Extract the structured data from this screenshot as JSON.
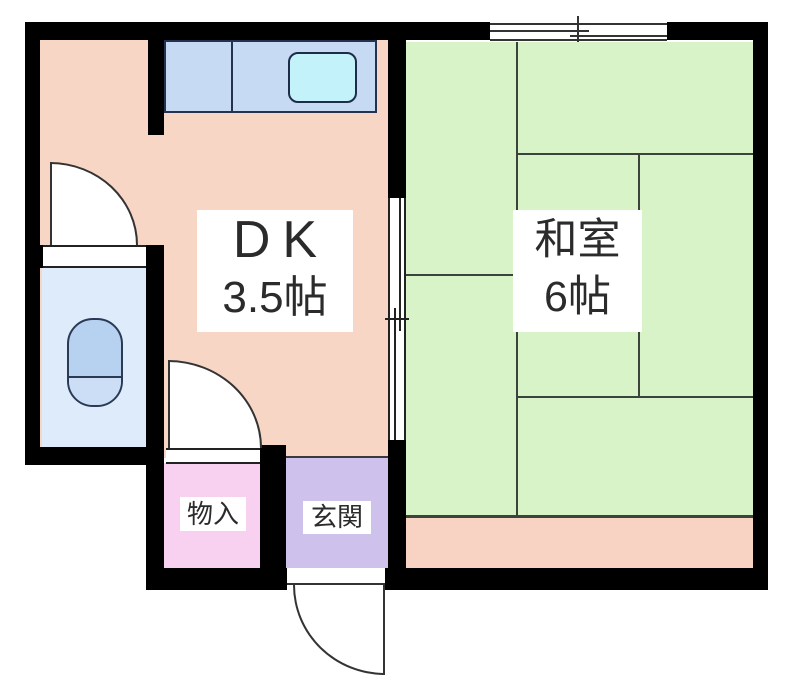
{
  "colors": {
    "background": "#ffffff",
    "wall": "#000000",
    "tatami_line": "#3a443a",
    "outline": "#333333",
    "text": "#2b2b2b",
    "dk_fill": "#f8d6c6",
    "washitsu_fill": "#d9f3c8",
    "veranda_fill": "#f8d2c3",
    "toilet_room_fill": "#ddebfa",
    "toilet_fixture_fill": "#b7d2f0",
    "toilet_bowl_fill": "#cbdef6",
    "counter_fill": "#c7daf4",
    "sink_fill": "#c4f2fb",
    "storage_fill": "#f8d0f0",
    "entrance_fill": "#cec2ec",
    "label_bg": "#ffffff"
  },
  "rooms": {
    "dk": {
      "name": "DK",
      "size": "3.5帖"
    },
    "washitsu": {
      "name": "和室",
      "size": "6帖"
    },
    "storage": {
      "label": "物入"
    },
    "entrance": {
      "label": "玄関"
    }
  }
}
